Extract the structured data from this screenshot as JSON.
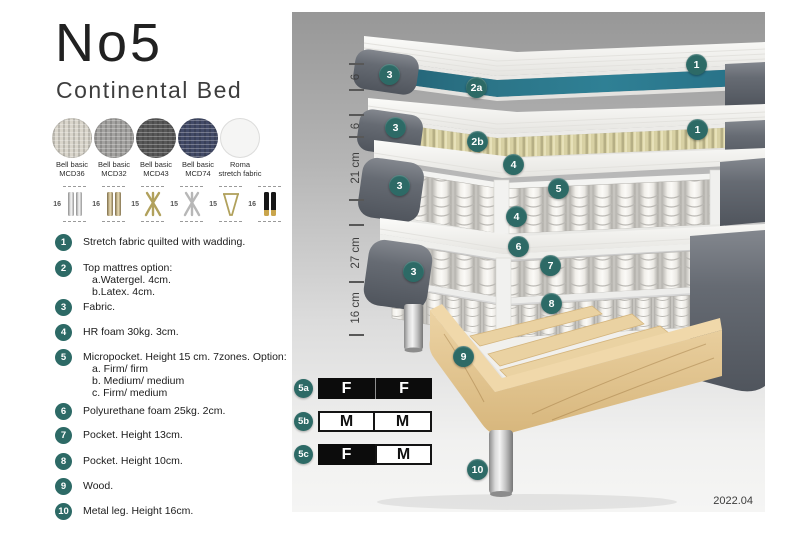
{
  "header": {
    "title": "No5",
    "subtitle": "Continental Bed"
  },
  "fabrics": [
    {
      "line1": "Bell basic",
      "line2": "MCD36",
      "color": "#d9d5cb"
    },
    {
      "line1": "Bell basic",
      "line2": "MCD32",
      "color": "#a3a2a0"
    },
    {
      "line1": "Bell basic",
      "line2": "MCD43",
      "color": "#585858"
    },
    {
      "line1": "Bell basic",
      "line2": "MCD74",
      "color": "#424a67"
    },
    {
      "line1": "Roma",
      "line2": "stretch fabric",
      "color": "#f5f5f4"
    }
  ],
  "legs": [
    {
      "height": "16",
      "icon": "cylinder-silver"
    },
    {
      "height": "16",
      "icon": "cylinder-brass"
    },
    {
      "height": "15",
      "icon": "splayed-gold"
    },
    {
      "height": "15",
      "icon": "splayed-silver"
    },
    {
      "height": "15",
      "icon": "hairpin-gold"
    },
    {
      "height": "16",
      "icon": "cylinder-black-gold"
    }
  ],
  "list": [
    {
      "num": "1",
      "line1": "Stretch fabric quilted with wadding."
    },
    {
      "num": "2",
      "line1": "Top mattres option:",
      "sub": [
        "a.Watergel. 4cm.",
        "b.Latex. 4cm."
      ]
    },
    {
      "num": "3",
      "line1": "Fabric."
    },
    {
      "num": "4",
      "line1": "HR foam 30kg. 3cm."
    },
    {
      "num": "5",
      "line1": "Micropocket. Height 15 cm. 7zones. Option:",
      "sub": [
        "a. Firm/ firm",
        "b. Medium/ medium",
        "c. Firm/ medium"
      ]
    },
    {
      "num": "6",
      "line1": "Polyurethane foam 25kg. 2cm."
    },
    {
      "num": "7",
      "line1": "Pocket. Height 13cm."
    },
    {
      "num": "8",
      "line1": "Pocket. Height 10cm."
    },
    {
      "num": "9",
      "line1": "Wood."
    },
    {
      "num": "10",
      "line1": "Metal leg. Height 16cm."
    }
  ],
  "diagram": {
    "ruler": [
      {
        "label": "6"
      },
      {
        "label": "6"
      },
      {
        "label": "21 cm"
      },
      {
        "label": "27 cm"
      },
      {
        "label": "16 cm"
      }
    ],
    "callouts": [
      {
        "label": "3"
      },
      {
        "label": "2a"
      },
      {
        "label": "1"
      },
      {
        "label": "3"
      },
      {
        "label": "2b"
      },
      {
        "label": "1"
      },
      {
        "label": "4"
      },
      {
        "label": "5"
      },
      {
        "label": "3"
      },
      {
        "label": "4"
      },
      {
        "label": "6"
      },
      {
        "label": "3"
      },
      {
        "label": "7"
      },
      {
        "label": "8"
      },
      {
        "label": "9"
      },
      {
        "label": "10"
      }
    ],
    "firmness": {
      "rows": [
        {
          "label": "5a",
          "cell1": "F",
          "cell2": "F"
        },
        {
          "label": "5b",
          "cell1": "M",
          "cell2": "M"
        },
        {
          "label": "5c",
          "cell1": "F",
          "cell2": "M"
        }
      ]
    },
    "version": "2022.04"
  },
  "colors": {
    "badge_teal": "#2d6a66",
    "watergel_teal": "#2b7689",
    "latex_yellow": "#d8d1a4",
    "upholstery_gray": "#5d6269",
    "wood_tan": "#e2c28c",
    "firmness_dark_bg": "#0c0c0c",
    "panel_bg_top": "#979797",
    "panel_bg_bottom": "#f5f5f4"
  }
}
